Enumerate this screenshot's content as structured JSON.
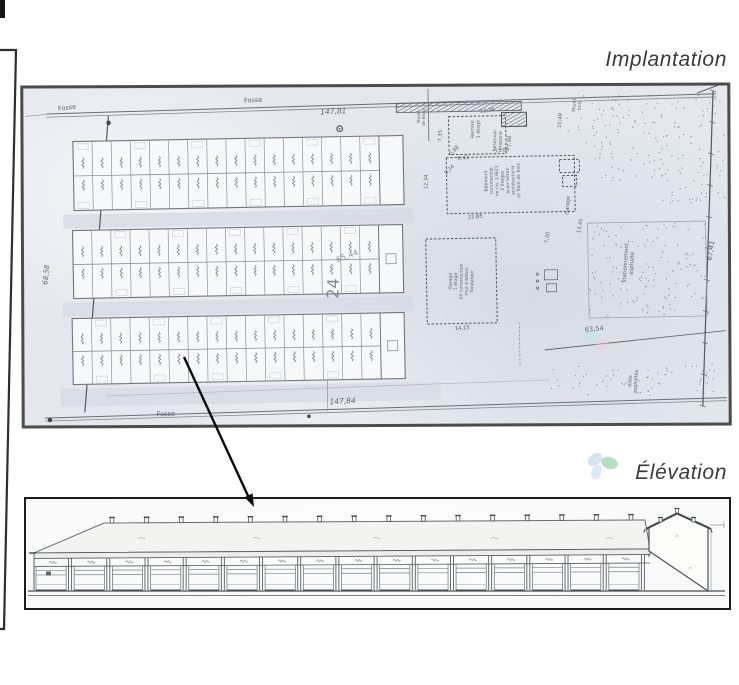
{
  "titles": {
    "implantation": "Implantation",
    "elevation": "Élévation"
  },
  "colors": {
    "paper": "#e4e8ee",
    "plan_ink": "#565a62",
    "plan_line": "#6a6e76",
    "plan_border": "#4c4c4a",
    "elevation_border": "#1c1c1c",
    "elevation_ink": "#595c62",
    "elevation_dark": "#44474c",
    "title_text": "#3a3a3c",
    "pencil": "#7d828c",
    "stipple": "#6f747d",
    "petal_green": "#a3d7ae",
    "petal_blue": "#c6d5ea",
    "petal_pale": "#cfdff2",
    "arrow": "#0b0b0b",
    "frame": "#2e2e2e"
  },
  "site_plan": {
    "blocks": {
      "count": 3,
      "columns_per_block": 16,
      "rows_per_block": 2,
      "end_cell": true
    },
    "annotations": [
      {
        "t": "Fosse",
        "x": 46,
        "y": 17,
        "r": -6,
        "s": 6.5
      },
      {
        "t": "Fosse",
        "x": 232,
        "y": 13,
        "r": -2,
        "s": 6.5
      },
      {
        "t": "147,81",
        "x": 312,
        "y": 26,
        "r": -2,
        "s": 7.5,
        "b": 1
      },
      {
        "t": "Fosse",
        "x": 139,
        "y": 325,
        "r": -1,
        "s": 6.5
      },
      {
        "t": "147,84",
        "x": 316,
        "y": 316,
        "r": -2,
        "s": 7.5,
        "b": 1
      },
      {
        "t": "68,58",
        "x": 24,
        "y": 182,
        "r": -83,
        "s": 7,
        "b": 1
      },
      {
        "t": "67,41",
        "x": 689,
        "y": 170,
        "r": -80,
        "s": 7,
        "b": 1
      },
      {
        "t": "63,54",
        "x": 569,
        "y": 248,
        "r": -4,
        "s": 6.5
      },
      {
        "t": "24",
        "x": 314,
        "y": 201,
        "r": -87,
        "s": 16,
        "c": "#7d828c"
      },
      {
        "t": "65,44",
        "x": 324,
        "y": 171,
        "r": -20,
        "s": 8,
        "c": "#868b95"
      },
      {
        "t": "Remise\n1 étage",
        "x": 455,
        "y": 44,
        "r": -90,
        "s": 4.8
      },
      {
        "t": "7,35",
        "x": 420,
        "y": 50,
        "r": -88,
        "s": 5.2
      },
      {
        "t": "12,36",
        "x": 466,
        "y": 27,
        "r": -6,
        "s": 5.2
      },
      {
        "t": "8,41",
        "x": 441,
        "y": 74,
        "r": -4,
        "s": 5.2
      },
      {
        "t": "7,88",
        "x": 489,
        "y": 57,
        "r": -88,
        "s": 5.2
      },
      {
        "t": "8,34",
        "x": 428,
        "y": 85,
        "r": -45,
        "s": 5.2
      },
      {
        "t": "Réservoir\npropane",
        "x": 477,
        "y": 56,
        "r": -88,
        "s": 4.6
      },
      {
        "t": "10,49",
        "x": 540,
        "y": 37,
        "r": -85,
        "s": 5.2
      },
      {
        "t": "Muret\nbois",
        "x": 557,
        "y": 22,
        "r": -85,
        "s": 4.6
      },
      {
        "t": "Bâtiment\ncommercial\nno civ. 13621\n2 étages\nacier béton\narchitectural\net fibre de bois",
        "x": 481,
        "y": 96,
        "r": -90,
        "s": 4.6
      },
      {
        "t": "12,34",
        "x": 405,
        "y": 96,
        "r": -88,
        "s": 5.2
      },
      {
        "t": "0,88",
        "x": 433,
        "y": 66,
        "r": -45,
        "s": 5.2
      },
      {
        "t": "13,84",
        "x": 480,
        "y": 67,
        "r": -5,
        "s": 5.2
      },
      {
        "t": "22,85",
        "x": 452,
        "y": 133,
        "r": -3,
        "s": 5.2
      },
      {
        "t": "Garage",
        "x": 546,
        "y": 122,
        "r": -85,
        "s": 5.2
      },
      {
        "t": "13,45",
        "x": 558,
        "y": 143,
        "r": -78,
        "s": 5.2
      },
      {
        "t": "Garage\n1 étage\nen construction\nmur à béton\nfondation",
        "x": 438,
        "y": 196,
        "r": -88,
        "s": 4.6
      },
      {
        "t": "14,15",
        "x": 437,
        "y": 244,
        "r": -3,
        "s": 5.2
      },
      {
        "t": "7,30",
        "x": 525,
        "y": 154,
        "r": -80,
        "s": 5.2
      },
      {
        "t": "Stationnement\nasphalté",
        "x": 606,
        "y": 181,
        "r": -85,
        "s": 5.4
      },
      {
        "t": "Allée\nasphaltée",
        "x": 608,
        "y": 299,
        "r": -85,
        "s": 4.8
      },
      {
        "t": "Muret\nde blocs",
        "x": 401,
        "y": 31,
        "r": -88,
        "s": 4.2
      }
    ]
  },
  "elevation_drawing": {
    "bays": 16,
    "roof_vents": 16,
    "gable_section": true
  }
}
